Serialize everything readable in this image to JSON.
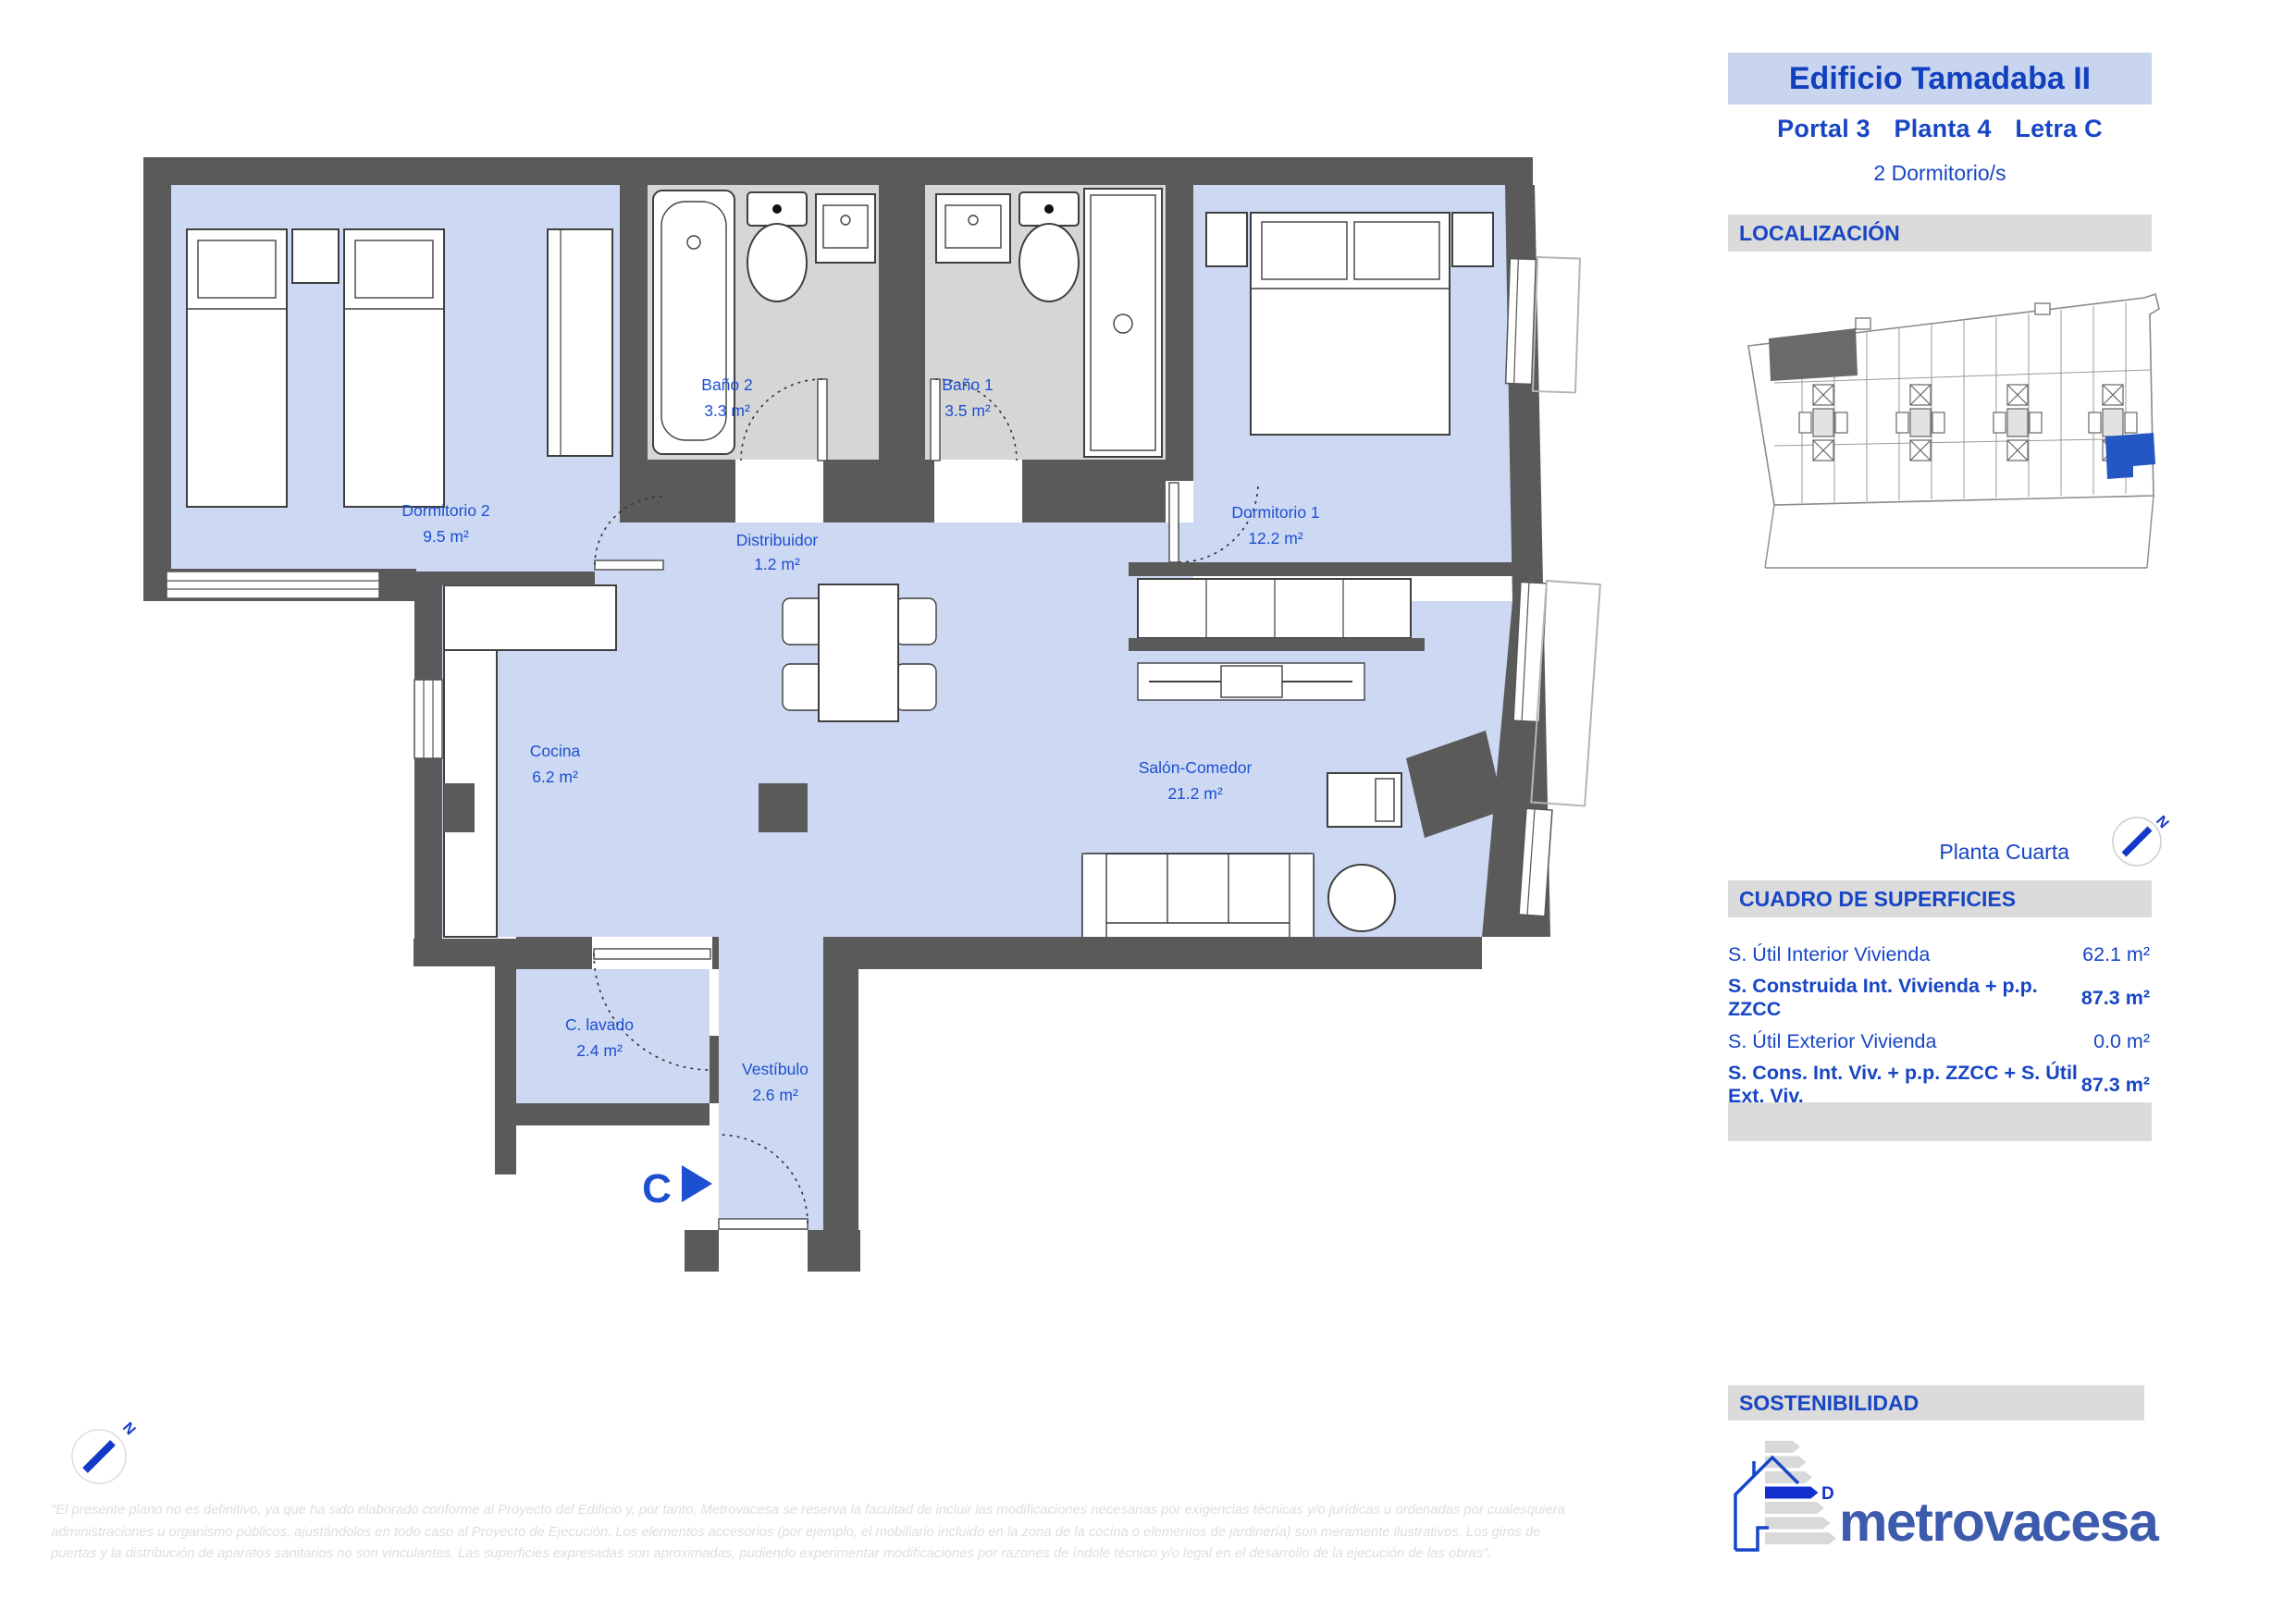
{
  "header": {
    "title": "Edificio Tamadaba II",
    "portal": "Portal 3",
    "planta": "Planta 4",
    "letra": "Letra C",
    "bedrooms": "2 Dormitorio/s"
  },
  "sections": {
    "localizacion": "LOCALIZACIÓN",
    "superficies": "CUADRO DE SUPERFICIES",
    "sostenibilidad": "SOSTENIBILIDAD"
  },
  "floor_label": "Planta Cuarta",
  "compass_letter": "N",
  "entrance": {
    "letter": "C"
  },
  "rooms": [
    {
      "name": "Dormitorio 2",
      "area": "9.5 m²"
    },
    {
      "name": "Baño 2",
      "area": "3.3 m²"
    },
    {
      "name": "Baño 1",
      "area": "3.5 m²"
    },
    {
      "name": "Distribuidor",
      "area": "1.2 m²"
    },
    {
      "name": "Dormitorio 1",
      "area": "12.2 m²"
    },
    {
      "name": "Cocina",
      "area": "6.2 m²"
    },
    {
      "name": "Salón-Comedor",
      "area": "21.2 m²"
    },
    {
      "name": "C. lavado",
      "area": "2.4 m²"
    },
    {
      "name": "Vestíbulo",
      "area": "2.6 m²"
    }
  ],
  "surfaces": {
    "rows": [
      {
        "label": "S. Útil Interior Vivienda",
        "value": "62.1 m²"
      },
      {
        "label": "S. Construida Int. Vivienda + p.p. ZZCC",
        "value": "87.3 m²"
      },
      {
        "label": "S. Útil Exterior Vivienda",
        "value": "0.0 m²"
      },
      {
        "label": "S. Cons. Int. Viv. + p.p. ZZCC + S. Útil Ext. Viv.",
        "value": "87.3 m²"
      }
    ]
  },
  "energy": {
    "rating": "D"
  },
  "brand": {
    "name": "metrovacesa"
  },
  "disclaimer": {
    "line1": "\"El presente plano no es definitivo, ya que ha sido elaborado conforme al Proyecto del Edificio y, por tanto, Metrovacesa se reserva la facultad de incluir las modificaciones necesarias por exigencias técnicas y/o jurídicas u ordenadas por cualesquiera",
    "line2": "administraciones u organismo públicos, ajustándolos en todo caso al Proyecto de Ejecución. Los elementos accesorios (por ejemplo, el mobiliario incluido en la zona de la cocina o elementos de jardinería) son meramente ilustrativos. Los giros de",
    "line3": "puertas y la distribución de aparatos sanitarios no son vinculantes. Las superficies expresadas son aproximadas, pudiendo experimentar modificaciones por razones de índole técnico y/o legal en el desarrollo de la ejecución de las obras\"."
  },
  "colors": {
    "accent_blue": "#1745c5",
    "room_label_blue": "#1d4fd1",
    "floor_blue": "#cdd9f3",
    "bath_gray": "#d6d6d6",
    "wall_gray": "#5a5a5a",
    "banner_blue": "#c9d5ef",
    "bar_gray": "#dbdbdb",
    "logo_blue": "#3d5bac",
    "map_highlight_blue": "#2456c4",
    "energy_rating_blue": "#1330cf"
  }
}
